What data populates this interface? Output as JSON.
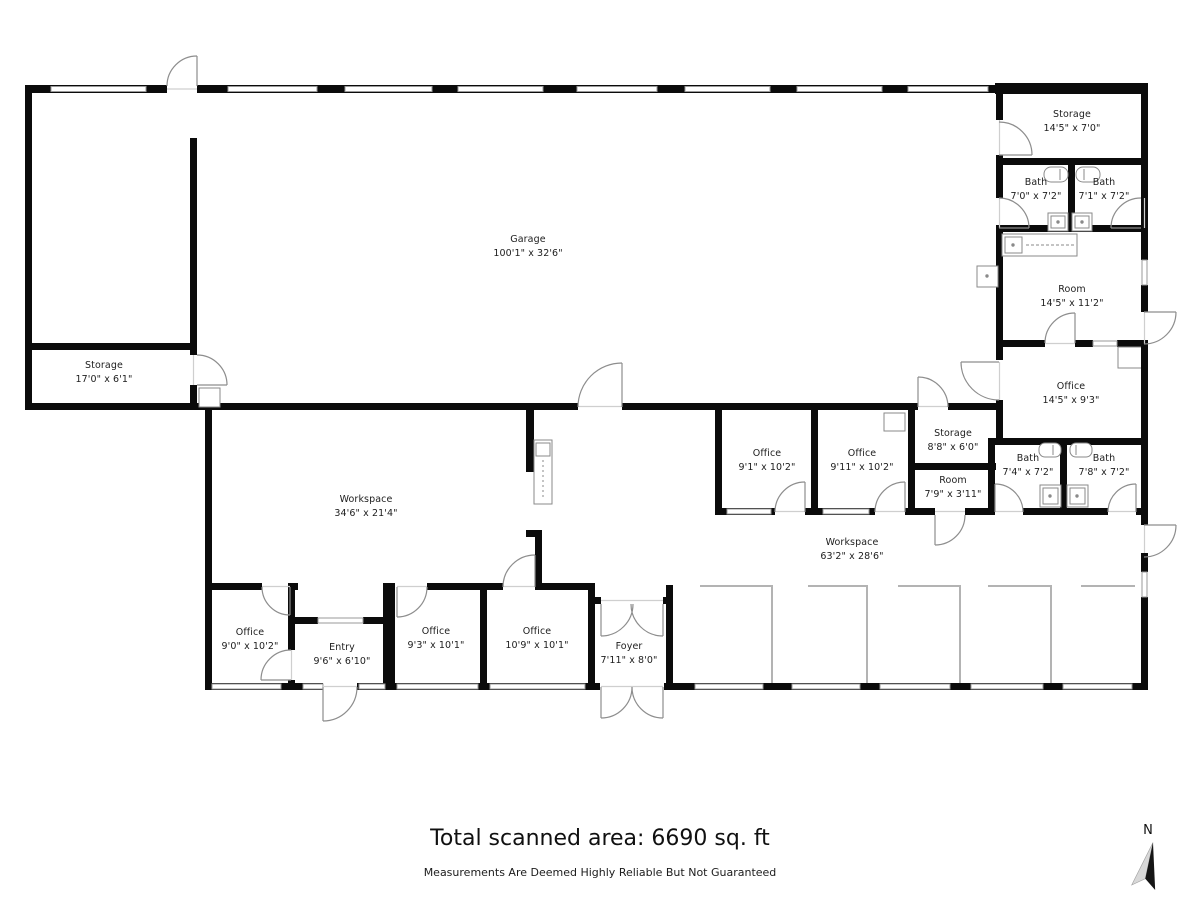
{
  "footer": {
    "total_area": "Total scanned area: 6690 sq. ft",
    "disclaimer": "Measurements Are Deemed Highly Reliable But Not Guaranteed"
  },
  "compass": {
    "label": "N"
  },
  "colors": {
    "wall": "#0b0b0b",
    "window": "#9a9a9a",
    "door_arc": "#8d8d8d",
    "partition": "#b3b3b3"
  },
  "rooms": [
    {
      "name": "Garage",
      "dims": "100'1\" x 32'6\""
    },
    {
      "name": "Storage",
      "dims": "17'0\" x 6'1\""
    },
    {
      "name": "Storage",
      "dims": "14'5\" x 7'0\""
    },
    {
      "name": "Bath",
      "dims": "7'0\" x 7'2\""
    },
    {
      "name": "Bath",
      "dims": "7'1\" x 7'2\""
    },
    {
      "name": "Room",
      "dims": "14'5\" x 11'2\""
    },
    {
      "name": "Office",
      "dims": "14'5\" x 9'3\""
    },
    {
      "name": "Storage",
      "dims": "8'8\" x 6'0\""
    },
    {
      "name": "Room",
      "dims": "7'9\" x 3'11\""
    },
    {
      "name": "Office",
      "dims": "9'1\" x 10'2\""
    },
    {
      "name": "Office",
      "dims": "9'11\" x 10'2\""
    },
    {
      "name": "Bath",
      "dims": "7'4\" x 7'2\""
    },
    {
      "name": "Bath",
      "dims": "7'8\" x 7'2\""
    },
    {
      "name": "Workspace",
      "dims": "34'6\" x 21'4\""
    },
    {
      "name": "Workspace",
      "dims": "63'2\" x 28'6\""
    },
    {
      "name": "Office",
      "dims": "9'0\" x 10'2\""
    },
    {
      "name": "Entry",
      "dims": "9'6\" x 6'10\""
    },
    {
      "name": "Office",
      "dims": "9'3\" x 10'1\""
    },
    {
      "name": "Office",
      "dims": "10'9\" x 10'1\""
    },
    {
      "name": "Foyer",
      "dims": "7'11\" x 8'0\""
    }
  ]
}
